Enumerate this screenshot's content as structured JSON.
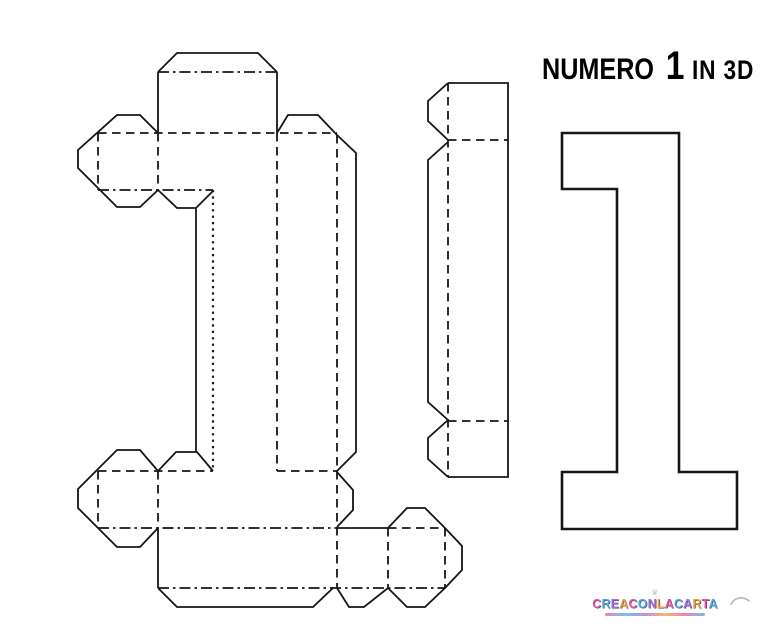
{
  "title": {
    "word": "NUMERO",
    "number": "1",
    "suffix": "IN 3D"
  },
  "logo": {
    "text": "CREACONLACARTA",
    "letter_colors": [
      "#e8559d",
      "#4fa8e0",
      "#a070d4",
      "#f0a03c"
    ]
  },
  "colors": {
    "line": "#161616",
    "background": "#ffffff",
    "title_text": "#000000"
  },
  "diagram": {
    "type": "papercraft-template",
    "pieces": [
      "number-1-unfolded-net-with-glue-tabs",
      "side-wall-strip-with-glue-tabs",
      "number-1-back-face-outline"
    ],
    "line_legend": {
      "solid": "cut line",
      "dashed": "fold line"
    }
  }
}
